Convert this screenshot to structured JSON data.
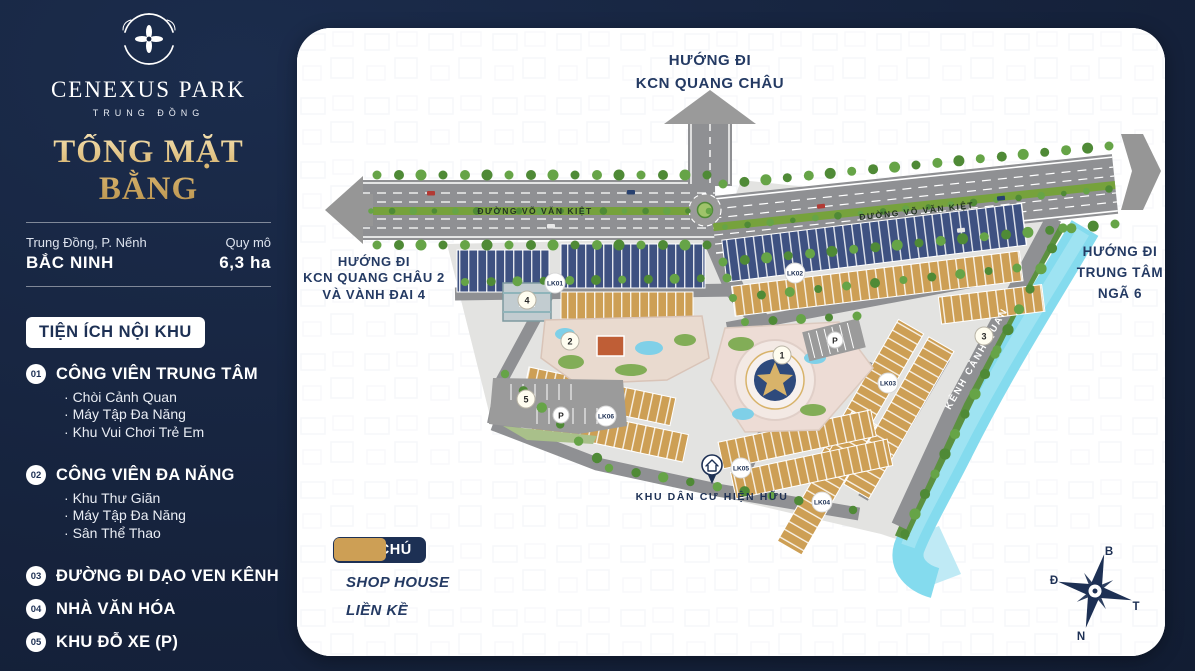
{
  "sidebar": {
    "brand": {
      "name": "CENEXUS PARK",
      "sub": "TRUNG ĐỒNG"
    },
    "title": "TỔNG MẶT BẰNG",
    "location": {
      "line1": "Trung Đồng, P. Nếnh",
      "line2": "BẮC NINH"
    },
    "scale": {
      "label": "Quy mô",
      "value": "6,3 ha"
    },
    "amenities": {
      "heading": "TIỆN ÍCH NỘI KHU",
      "items": [
        {
          "num": "01",
          "label": "CÔNG VIÊN TRUNG TÂM",
          "subs": [
            "Chòi Cảnh Quan",
            "Máy Tập Đa Năng",
            "Khu Vui Chơi Trẻ Em"
          ]
        },
        {
          "num": "02",
          "label": "CÔNG VIÊN ĐA NĂNG",
          "subs": [
            "Khu Thư Giãn",
            "Máy Tập Đa Năng",
            "Sân Thể Thao"
          ]
        },
        {
          "num": "03",
          "label": "ĐƯỜNG ĐI DẠO VEN KÊNH",
          "subs": []
        },
        {
          "num": "04",
          "label": "NHÀ VĂN HÓA",
          "subs": []
        },
        {
          "num": "05",
          "label": "KHU ĐỖ XE (P)",
          "subs": []
        }
      ]
    }
  },
  "map": {
    "direction_top": [
      "HƯỚNG ĐI",
      "KCN QUANG CHÂU"
    ],
    "direction_left": [
      "HƯỚNG ĐI",
      "KCN QUANG CHÂU 2",
      "VÀ VÀNH ĐAI 4"
    ],
    "direction_right": [
      "HƯỚNG ĐI",
      "TRUNG TÂM",
      "NGÃ 6"
    ],
    "road_name": "ĐƯỜNG VÕ VĂN KIỆT",
    "canal_name": "KÊNH CẢNH QUAN",
    "existing_area": "KHU DÂN CƯ HIỆN HỮU",
    "blocks": [
      "LK01",
      "LK02",
      "LK03",
      "LK04",
      "LK05",
      "LK06"
    ],
    "markers": [
      "1",
      "2",
      "3",
      "4",
      "5"
    ],
    "parking_label": "P",
    "compass": {
      "top": "B",
      "left": "Đ",
      "right": "T",
      "bottom": "N"
    }
  },
  "legend": {
    "heading": "GHI CHÚ",
    "items": [
      {
        "label": "SHOP HOUSE",
        "color": "#46578a"
      },
      {
        "label": "LIỀN KỀ",
        "color": "#cd9f55"
      }
    ]
  },
  "colors": {
    "navy_bg": "#16233d",
    "gold": "#d9b671",
    "shophouse": "#3e5181",
    "lienke": "#cd9f55",
    "canal": "#84dbee",
    "road": "#8f9093",
    "tree": "#4f8a36"
  }
}
